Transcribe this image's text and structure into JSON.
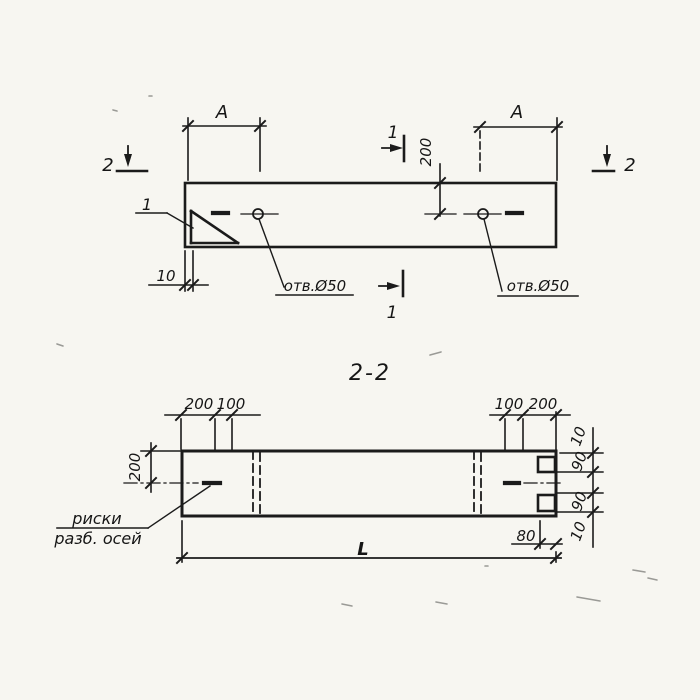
{
  "colors": {
    "paper": "#f7f6f1",
    "ink": "#1b1b1b"
  },
  "plan": {
    "dim_a_left": "A",
    "dim_a_right": "A",
    "dim_depth": "200",
    "dim_offset": "10",
    "detail_mark": "1",
    "hole_label_left": "отв.Ø50",
    "hole_label_right": "отв.Ø50",
    "section_1": {
      "top": "1",
      "bottom": "1"
    },
    "section_2": {
      "left": "2",
      "right": "2"
    }
  },
  "section": {
    "title": "2-2",
    "dims_top_left": [
      "200",
      "100"
    ],
    "dims_top_right": [
      "100",
      "200"
    ],
    "dim_height": "200",
    "dims_right": [
      "10",
      "90",
      "90",
      "10"
    ],
    "dim_groove_depth": "80",
    "dim_length": "L",
    "axis_note": [
      "риски",
      "разб. осей"
    ]
  }
}
